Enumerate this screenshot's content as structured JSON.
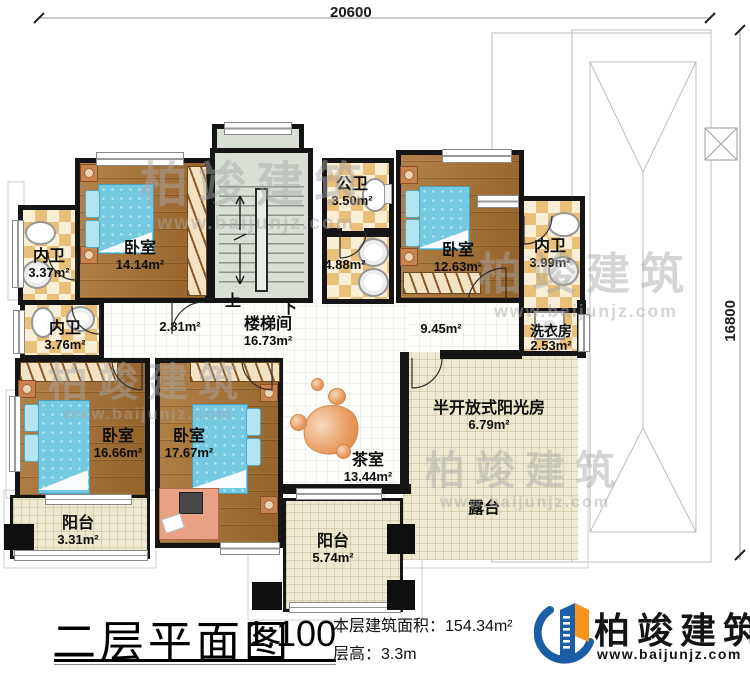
{
  "title_block": {
    "title": "二层平面图",
    "scale": "1:100",
    "area_label": "本层建筑面积：",
    "area_value": "154.34m²",
    "height_label": "层高：",
    "height_value": "3.3m"
  },
  "logo": {
    "name": "柏竣建筑",
    "url": "www.baijunjz.com"
  },
  "watermark": {
    "text": "柏竣建筑",
    "url": "www.baijunjz.com"
  },
  "dimensions": {
    "top": "20600",
    "right": "16800"
  },
  "stairs": {
    "up": "上",
    "down": "下"
  },
  "rooms": {
    "bedroom_tl": {
      "name": "卧室",
      "area": "14.14m²"
    },
    "bedroom_tr": {
      "name": "卧室",
      "area": "12.63m²"
    },
    "bedroom_bl": {
      "name": "卧室",
      "area": "16.66m²"
    },
    "bedroom_bc": {
      "name": "卧室",
      "area": "17.67m²"
    },
    "bath_tl": {
      "name": "内卫",
      "area": "3.37m²"
    },
    "bath_ml": {
      "name": "内卫",
      "area": "3.76m²"
    },
    "bath_tr": {
      "name": "内卫",
      "area": "3.99m²"
    },
    "public_bath": {
      "name": "公卫",
      "area": "3.50m²"
    },
    "vanity": {
      "name": "",
      "area": "4.88m²"
    },
    "corridor_w": {
      "name": "",
      "area": "2.81m²"
    },
    "corridor_e": {
      "name": "",
      "area": "9.45m²"
    },
    "stairwell": {
      "name": "楼梯间",
      "area": "16.73m²"
    },
    "laundry": {
      "name": "洗衣房",
      "area": "2.53m²"
    },
    "tearoom": {
      "name": "茶室",
      "area": "13.44m²"
    },
    "sunroom": {
      "name": "半开放式阳光房",
      "area": "6.79m²"
    },
    "terrace": {
      "name": "露台",
      "area": ""
    },
    "balcony_bl": {
      "name": "阳台",
      "area": "3.31m²"
    },
    "balcony_bc": {
      "name": "阳台",
      "area": "5.74m²"
    }
  },
  "colors": {
    "wall": "#151515",
    "wood_floor": "#a8702f",
    "tile_checker": "#e9c07a",
    "bed_blue": "#74c9e0",
    "balcony_cream": "#eee8d1",
    "logo_blue": "#1b5ea6",
    "logo_orange": "#f7941d"
  }
}
